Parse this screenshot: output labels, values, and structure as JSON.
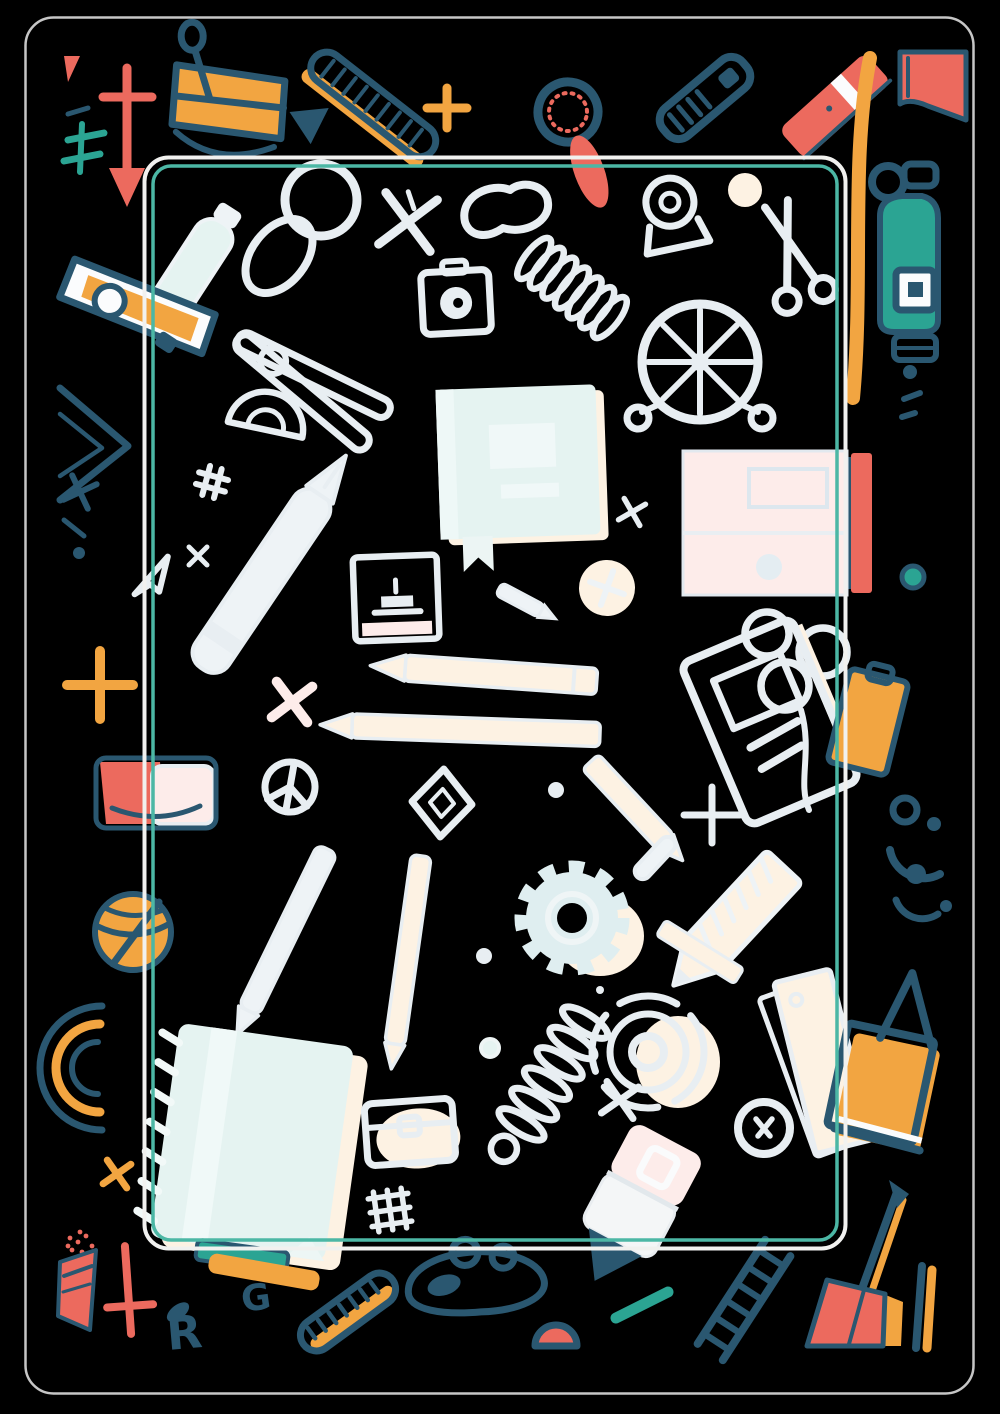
{
  "artwork": {
    "title": "school-supplies-doodle-poster",
    "background_color": "#000000",
    "palette": {
      "bg": "#000000",
      "bordergray": "#c6c6c6",
      "framewhite": "#f1f1ef",
      "frameteal": "#4cb7a5",
      "doodle": "#e8eef2",
      "doodlelite": "#eef3f6",
      "cream": "#fdf2e3",
      "pink": "#fdecea",
      "mint": "#e5f3f1",
      "navy": "#2a5770",
      "orange": "#f2a541",
      "coral": "#ec6a5e",
      "teal": "#2ba493"
    },
    "frame": {
      "outer_border": {
        "x": 25,
        "y": 17,
        "width": 948,
        "height": 1376,
        "radius": 28,
        "color_key": "bordergray"
      },
      "inner_frame_white": {
        "x": 144,
        "y": 157,
        "width": 701,
        "height": 1091,
        "radius": 24,
        "color_key": "framewhite"
      },
      "inner_frame_teal": {
        "x": 153,
        "y": 166,
        "width": 684,
        "height": 1074,
        "radius": 18,
        "color_key": "frameteal"
      }
    },
    "letters": {
      "g": "G",
      "r": "R"
    },
    "items": [
      {
        "name": "red-arrow-pin",
        "region": [
          103,
          55,
          50,
          155
        ],
        "colors": [
          "coral"
        ]
      },
      {
        "name": "teal-not-equal-sign",
        "region": [
          62,
          108,
          50,
          70
        ],
        "colors": [
          "teal",
          "navy"
        ]
      },
      {
        "name": "binder-clip",
        "region": [
          160,
          55,
          135,
          115
        ],
        "colors": [
          "orange",
          "navy"
        ]
      },
      {
        "name": "zipper-ruler",
        "region": [
          305,
          55,
          140,
          110
        ],
        "colors": [
          "navy",
          "orange"
        ]
      },
      {
        "name": "orange-plus-small",
        "region": [
          425,
          85,
          45,
          45
        ],
        "colors": [
          "orange"
        ]
      },
      {
        "name": "red-magnifier",
        "region": [
          525,
          70,
          95,
          115
        ],
        "colors": [
          "navy",
          "coral"
        ]
      },
      {
        "name": "navy-cutter",
        "region": [
          660,
          55,
          95,
          90
        ],
        "colors": [
          "navy"
        ]
      },
      {
        "name": "red-marker",
        "region": [
          785,
          55,
          100,
          105
        ],
        "colors": [
          "coral"
        ]
      },
      {
        "name": "long-orange-pencil",
        "region": [
          845,
          55,
          30,
          365
        ],
        "colors": [
          "orange"
        ]
      },
      {
        "name": "red-book-corner",
        "region": [
          898,
          50,
          70,
          75
        ],
        "colors": [
          "coral",
          "navy"
        ]
      },
      {
        "name": "teal-spray-bottle",
        "region": [
          876,
          150,
          65,
          225
        ],
        "colors": [
          "teal",
          "navy"
        ]
      },
      {
        "name": "teal-dot",
        "region": [
          900,
          565,
          25,
          25
        ],
        "colors": [
          "teal",
          "navy"
        ]
      },
      {
        "name": "orange-clipboard",
        "region": [
          838,
          670,
          60,
          105
        ],
        "colors": [
          "orange",
          "navy"
        ]
      },
      {
        "name": "navy-arc-dots",
        "region": [
          883,
          790,
          70,
          130
        ],
        "colors": [
          "navy"
        ]
      },
      {
        "name": "white-papers",
        "region": [
          790,
          965,
          70,
          195
        ],
        "colors": [
          "cream",
          "doodle"
        ]
      },
      {
        "name": "orange-tote-bag",
        "region": [
          835,
          965,
          100,
          200
        ],
        "colors": [
          "orange",
          "navy"
        ]
      },
      {
        "name": "red-dustpan-pencil",
        "region": [
          805,
          1180,
          100,
          170
        ],
        "colors": [
          "coral",
          "orange",
          "navy"
        ]
      },
      {
        "name": "partial-pencil-right",
        "region": [
          908,
          1260,
          30,
          90
        ],
        "colors": [
          "navy",
          "orange"
        ]
      },
      {
        "name": "red-sharpener-flag",
        "region": [
          56,
          1228,
          45,
          105
        ],
        "colors": [
          "coral",
          "navy"
        ]
      },
      {
        "name": "red-cross",
        "region": [
          100,
          1244,
          55,
          95
        ],
        "colors": [
          "coral"
        ]
      },
      {
        "name": "letter-g-doodle",
        "region": [
          243,
          1282,
          25,
          30
        ],
        "colors": [
          "navy"
        ]
      },
      {
        "name": "letter-r-doodle",
        "region": [
          163,
          1305,
          50,
          48
        ],
        "colors": [
          "navy"
        ]
      },
      {
        "name": "orange-zipper-pen",
        "region": [
          300,
          1275,
          95,
          75
        ],
        "colors": [
          "navy",
          "orange"
        ]
      },
      {
        "name": "navy-goggles",
        "region": [
          405,
          1248,
          145,
          65
        ],
        "colors": [
          "navy"
        ]
      },
      {
        "name": "navy-smile-arc",
        "region": [
          530,
          1325,
          50,
          25
        ],
        "colors": [
          "navy",
          "coral"
        ]
      },
      {
        "name": "teal-dash",
        "region": [
          610,
          1288,
          62,
          34
        ],
        "colors": [
          "teal"
        ]
      },
      {
        "name": "navy-ladder",
        "region": [
          695,
          1250,
          100,
          100
        ],
        "colors": [
          "navy"
        ]
      },
      {
        "name": "stapler-punch",
        "region": [
          60,
          245,
          160,
          120
        ],
        "colors": [
          "navy",
          "orange"
        ]
      },
      {
        "name": "white-bottle",
        "region": [
          148,
          205,
          90,
          130
        ],
        "colors": [
          "doodle",
          "mint"
        ]
      },
      {
        "name": "navy-set-square",
        "region": [
          55,
          385,
          80,
          160
        ],
        "colors": [
          "navy"
        ]
      },
      {
        "name": "orange-plus-large",
        "region": [
          62,
          645,
          75,
          80
        ],
        "colors": [
          "orange"
        ]
      },
      {
        "name": "red-pencil-cup",
        "region": [
          92,
          755,
          130,
          75
        ],
        "colors": [
          "coral",
          "pink",
          "navy"
        ]
      },
      {
        "name": "orange-basketball",
        "region": [
          92,
          892,
          85,
          80
        ],
        "colors": [
          "orange",
          "navy"
        ]
      },
      {
        "name": "protractor-rainbow",
        "region": [
          30,
          1000,
          75,
          135
        ],
        "colors": [
          "navy",
          "orange"
        ]
      },
      {
        "name": "orange-x",
        "region": [
          103,
          1160,
          30,
          30
        ],
        "colors": [
          "orange"
        ]
      },
      {
        "name": "white-magnifier",
        "region": [
          265,
          170,
          105,
          110
        ],
        "colors": [
          "doodle",
          "cream",
          "pink"
        ]
      },
      {
        "name": "x-sketch",
        "region": [
          380,
          195,
          55,
          55
        ],
        "colors": [
          "doodle"
        ]
      },
      {
        "name": "bean-doodle",
        "region": [
          460,
          182,
          90,
          65
        ],
        "colors": [
          "doodle"
        ]
      },
      {
        "name": "camera-doodle",
        "region": [
          420,
          262,
          75,
          80
        ],
        "colors": [
          "doodle"
        ]
      },
      {
        "name": "spring-coil-diagonal",
        "region": [
          512,
          222,
          120,
          130
        ],
        "colors": [
          "doodle"
        ]
      },
      {
        "name": "tape-dispenser",
        "region": [
          640,
          175,
          65,
          80
        ],
        "colors": [
          "doodle"
        ]
      },
      {
        "name": "scissors-doodle",
        "region": [
          745,
          200,
          95,
          105
        ],
        "colors": [
          "doodle"
        ]
      },
      {
        "name": "ferris-wheel",
        "region": [
          632,
          295,
          135,
          135
        ],
        "colors": [
          "doodle"
        ]
      },
      {
        "name": "clothespin-doodle",
        "region": [
          225,
          305,
          175,
          160
        ],
        "colors": [
          "doodle"
        ]
      },
      {
        "name": "mint-book",
        "region": [
          435,
          385,
          165,
          160
        ],
        "colors": [
          "mint"
        ]
      },
      {
        "name": "protractor-doodle",
        "region": [
          228,
          382,
          85,
          70
        ],
        "colors": [
          "doodle"
        ]
      },
      {
        "name": "big-white-pen",
        "region": [
          175,
          455,
          175,
          240
        ],
        "colors": [
          "doodle"
        ]
      },
      {
        "name": "photo-frame-doodle",
        "region": [
          352,
          554,
          90,
          90
        ],
        "colors": [
          "doodle",
          "pink"
        ]
      },
      {
        "name": "compass-face",
        "region": [
          577,
          558,
          62,
          62
        ],
        "colors": [
          "cream",
          "doodle"
        ]
      },
      {
        "name": "pink-storage-box",
        "region": [
          680,
          450,
          195,
          150
        ],
        "colors": [
          "pink",
          "coral",
          "navy"
        ]
      },
      {
        "name": "rings-trio",
        "region": [
          743,
          605,
          105,
          100
        ],
        "colors": [
          "doodle"
        ]
      },
      {
        "name": "white-pencil-left",
        "region": [
          370,
          655,
          225,
          40
        ],
        "colors": [
          "cream"
        ]
      },
      {
        "name": "white-pencil-left-2",
        "region": [
          318,
          710,
          285,
          40
        ],
        "colors": [
          "cream"
        ]
      },
      {
        "name": "tilted-notebook-sketch",
        "region": [
          690,
          628,
          160,
          190
        ],
        "colors": [
          "doodle",
          "cream"
        ]
      },
      {
        "name": "peace-circle",
        "region": [
          262,
          760,
          58,
          58
        ],
        "colors": [
          "doodle"
        ]
      },
      {
        "name": "diamond-outline",
        "region": [
          410,
          768,
          65,
          70
        ],
        "colors": [
          "doodle"
        ]
      },
      {
        "name": "cream-pencil-diagonal",
        "region": [
          585,
          760,
          90,
          90
        ],
        "colors": [
          "cream"
        ]
      },
      {
        "name": "white-plus",
        "region": [
          684,
          787,
          58,
          58
        ],
        "colors": [
          "doodle"
        ]
      },
      {
        "name": "pencil-diagonal-lower-left",
        "region": [
          240,
          845,
          100,
          170
        ],
        "colors": [
          "doodle"
        ]
      },
      {
        "name": "pencil-vertical",
        "region": [
          385,
          852,
          50,
          200
        ],
        "colors": [
          "cream"
        ]
      },
      {
        "name": "mint-gear",
        "region": [
          515,
          862,
          115,
          115
        ],
        "colors": [
          "mint",
          "cream"
        ]
      },
      {
        "name": "big-cream-pencil",
        "region": [
          670,
          840,
          140,
          145
        ],
        "colors": [
          "cream"
        ]
      },
      {
        "name": "spiral-notebook",
        "region": [
          150,
          1030,
          205,
          230
        ],
        "colors": [
          "mint",
          "cream"
        ]
      },
      {
        "name": "teal-orange-books",
        "region": [
          195,
          1242,
          130,
          35
        ],
        "colors": [
          "teal",
          "orange",
          "navy"
        ]
      },
      {
        "name": "slinky-spring",
        "region": [
          490,
          1000,
          115,
          180
        ],
        "colors": [
          "doodle"
        ]
      },
      {
        "name": "target-rings",
        "region": [
          585,
          995,
          135,
          120
        ],
        "colors": [
          "doodle",
          "cream"
        ]
      },
      {
        "name": "treasure-chest",
        "region": [
          362,
          1098,
          95,
          75
        ],
        "colors": [
          "doodle",
          "cream"
        ]
      },
      {
        "name": "grid-hash",
        "region": [
          365,
          1188,
          50,
          50
        ],
        "colors": [
          "doodle"
        ]
      },
      {
        "name": "white-eraser",
        "region": [
          555,
          1120,
          150,
          165
        ],
        "colors": [
          "pink",
          "navy"
        ]
      },
      {
        "name": "donut-ring",
        "region": [
          735,
          1100,
          60,
          60
        ],
        "colors": [
          "doodle"
        ]
      }
    ]
  }
}
